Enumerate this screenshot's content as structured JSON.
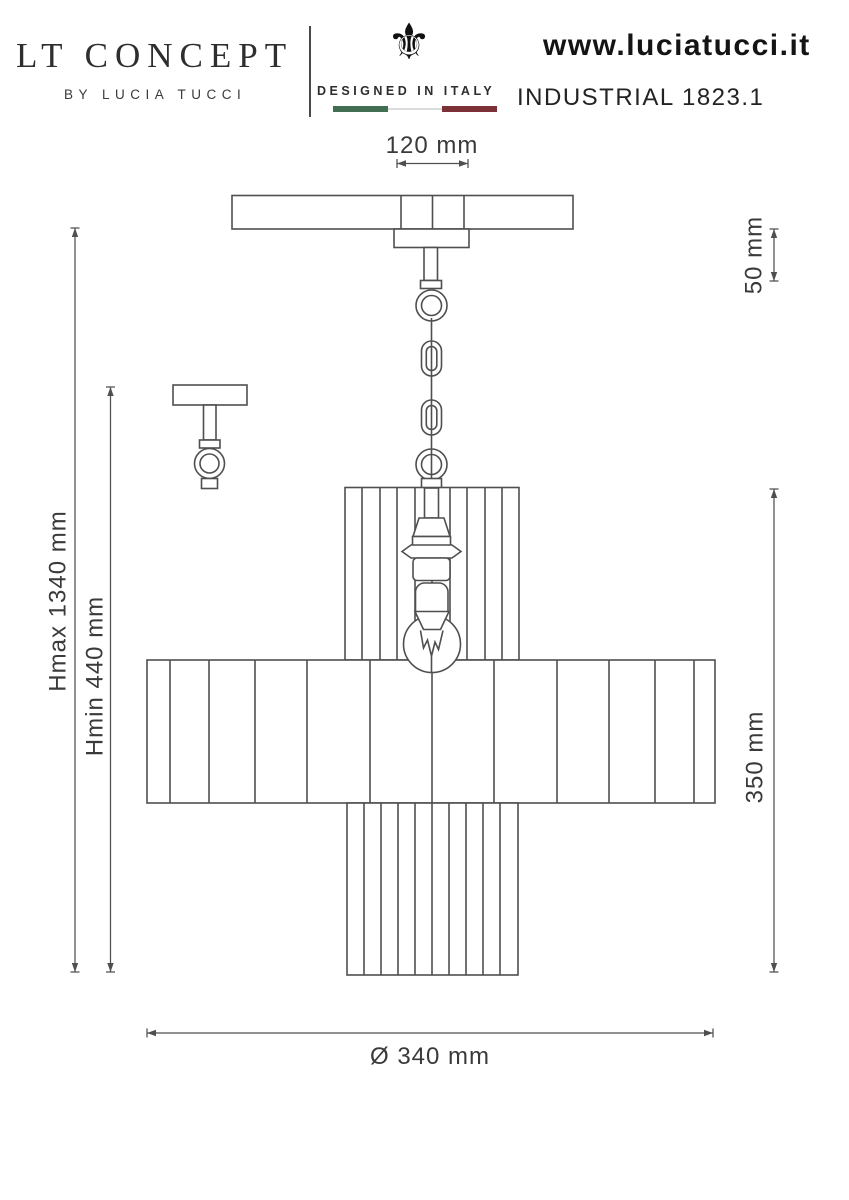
{
  "header": {
    "brand_title": "LT CONCEPT",
    "brand_subtitle": "BY LUCIA TUCCI",
    "fleur_icon": "⚜",
    "designed_label": "DESIGNED IN ITALY",
    "website": "www.luciatucci.it",
    "model": "INDUSTRIAL 1823.1",
    "flag_colors": {
      "green": "#426e51",
      "white": "#dcdcdc",
      "red": "#7c3038"
    }
  },
  "dimensions": {
    "canopy_width": "120 mm",
    "canopy_drop": "50 mm",
    "height_max": "Hmax 1340 mm",
    "height_min": "Hmin 440 mm",
    "shade_height": "350 mm",
    "shade_diameter": "Ø 340 mm"
  },
  "colors": {
    "drawing_line": "#4f4f4f",
    "hatch_line": "#a3a3a3",
    "dim_text": "#3a3a3a"
  }
}
